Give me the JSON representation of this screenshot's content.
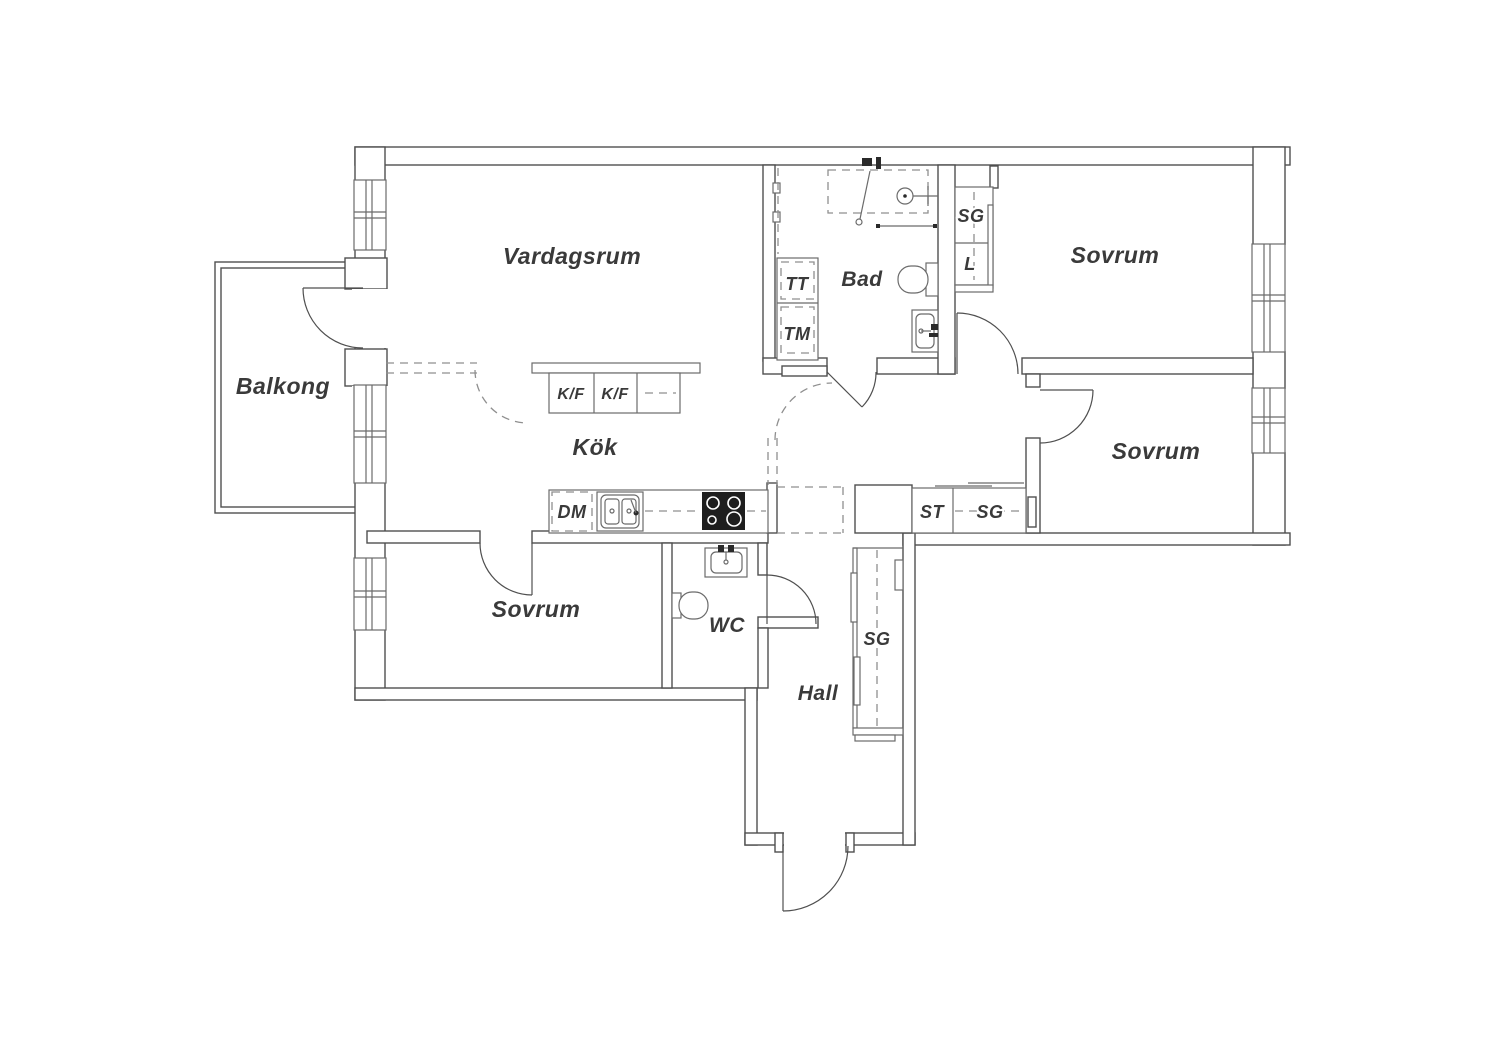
{
  "title": "Apartment floor plan",
  "colors": {
    "line": "#4f4f4f",
    "fixture": "#6b6b6b",
    "dash": "#8f8f8f",
    "text": "#3a3a3a",
    "stove": "#1e1e1e",
    "background": "#ffffff"
  },
  "rooms": {
    "vardagsrum": {
      "label": "Vardagsrum"
    },
    "balkong": {
      "label": "Balkong"
    },
    "kok": {
      "label": "Kök"
    },
    "bad": {
      "label": "Bad"
    },
    "wc": {
      "label": "WC"
    },
    "hall": {
      "label": "Hall"
    },
    "sovrum_top_right": {
      "label": "Sovrum"
    },
    "sovrum_mid_right": {
      "label": "Sovrum"
    },
    "sovrum_bottom_left": {
      "label": "Sovrum"
    }
  },
  "fixtures": {
    "tt": {
      "label": "TT"
    },
    "tm": {
      "label": "TM"
    },
    "sg_bathroom": {
      "label": "SG"
    },
    "linen": {
      "label": "L"
    },
    "st": {
      "label": "ST"
    },
    "sg_corridor": {
      "label": "SG"
    },
    "sg_hall": {
      "label": "SG"
    },
    "kf_left": {
      "label": "K/F"
    },
    "kf_right": {
      "label": "K/F"
    },
    "dm": {
      "label": "DM"
    }
  }
}
